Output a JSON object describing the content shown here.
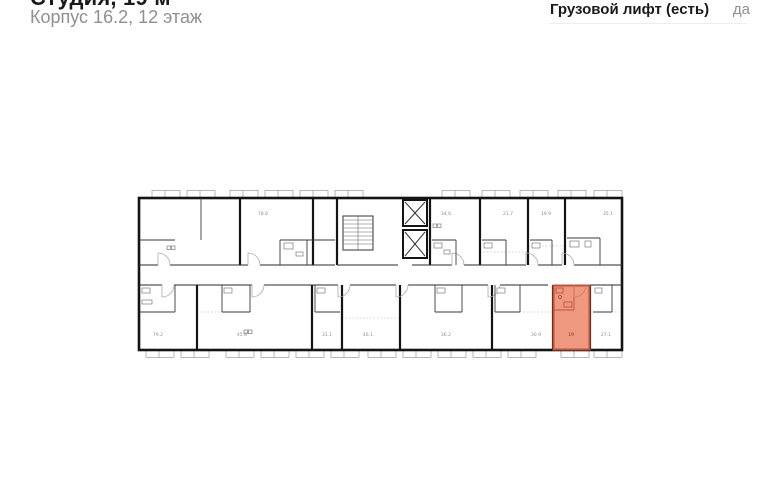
{
  "header": {
    "title": "Студия, 19 м²",
    "subtitle": "Корпус 16.2, 12 этаж"
  },
  "details": {
    "rows": [
      {
        "label": "Грузовой лифт (есть)",
        "value": "да"
      }
    ]
  },
  "floor_plan": {
    "units_top": [
      "78.6",
      "34.6",
      "21.7",
      "19.9",
      "35.1"
    ],
    "units_bottom": [
      "79.2",
      "45.8",
      "31.1",
      "46.1",
      "36.2",
      "30.9",
      "27.1"
    ],
    "selected_unit": {
      "area": "19",
      "fill": "#F0977F",
      "border": "#C0523C",
      "label_color": "#7B3526"
    },
    "colors": {
      "wall": "#141414",
      "detail": "#8F8F8F"
    }
  }
}
